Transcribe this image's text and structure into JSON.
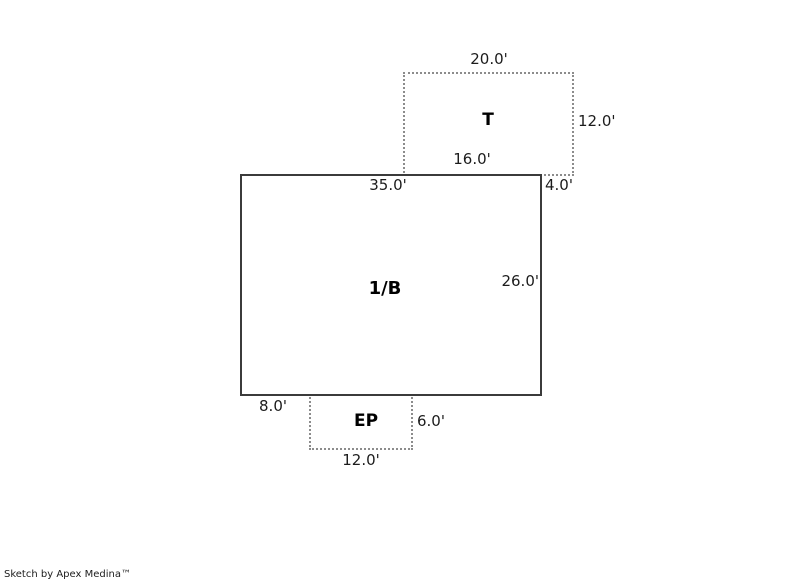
{
  "canvas": {
    "areas": {
      "t": {
        "label": "T",
        "dim_top": "20.0'",
        "dim_right": "12.0'",
        "dim_bottom": "16.0'",
        "dim_overhang_right": "4.0'"
      },
      "main": {
        "label": "1/B",
        "dim_top": "35.0'",
        "dim_right": "26.0'",
        "dim_bottom_offset_left": "8.0'"
      },
      "ep": {
        "label": "EP",
        "dim_right": "6.0'",
        "dim_bottom": "12.0'"
      }
    },
    "colors": {
      "solid_outline": "#3b3b3b",
      "dotted_outline": "#8c8c8c",
      "label_text": "#1c1c1c"
    }
  },
  "footer": {
    "credit": "Sketch by Apex Medina™"
  }
}
